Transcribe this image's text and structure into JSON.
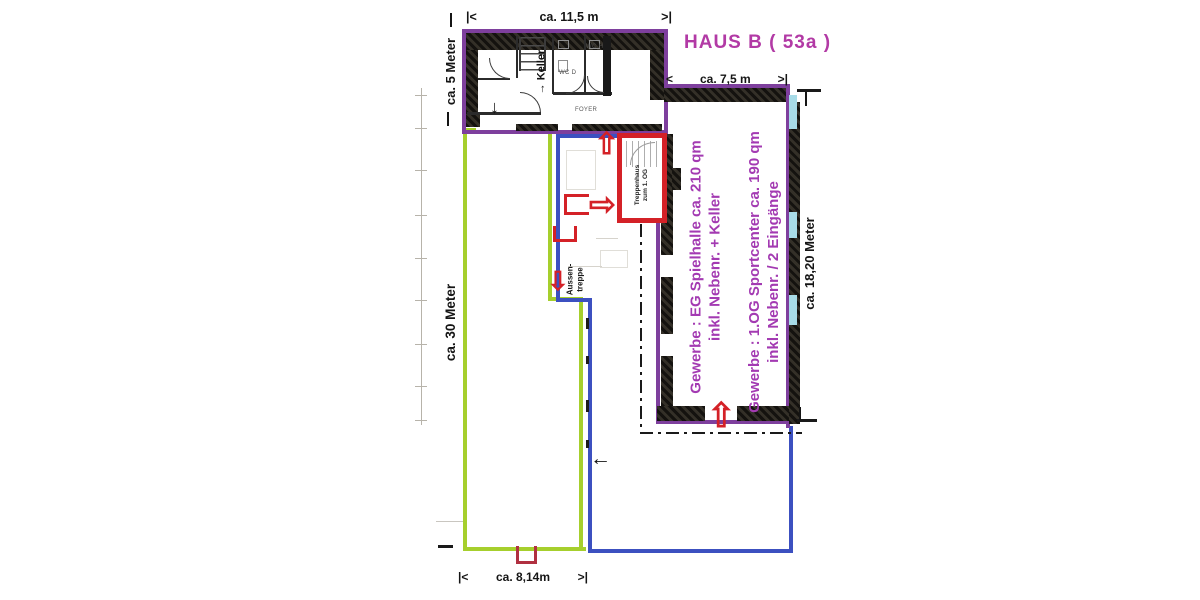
{
  "header": {
    "title": "HAUS B ( 53a )"
  },
  "dimensions": {
    "top": {
      "left_marker": "|<",
      "label": "ca. 11,5 m",
      "right_marker": ">|"
    },
    "wing": {
      "left_marker": "<",
      "label": "ca. 7,5 m",
      "right_marker": ">|"
    },
    "bottom": {
      "left_marker": "|<",
      "label": "ca. 8,14m",
      "right_marker": ">|"
    },
    "left_upper": "ca. 5 Meter",
    "left_lower": "ca. 30 Meter",
    "right_side": "ca. 18,20 Meter"
  },
  "floorplan_labels": {
    "keller_arrow": "→",
    "keller": "Keller",
    "wc_h": "WC H",
    "wc_d": "WC D",
    "foyer": "FOYER",
    "treppenhaus_line1": "Treppenhaus",
    "treppenhaus_line2": "zum 1. OG",
    "aussentreppe_line1": "Aussen-",
    "aussentreppe_line2": "treppe"
  },
  "annotations": {
    "gewerbe_eg": {
      "line1": "Gewerbe : EG Spielhalle ca. 210 qm",
      "line2": "inkl. Nebenr. + Keller"
    },
    "gewerbe_og": {
      "line1": "Gewerbe : 1.OG Sportcenter ca. 190 qm",
      "line2": "inkl. Nebenr. / 2 Eingänge"
    }
  },
  "icons": {
    "entrance_arrow_up": "⇧",
    "entrance_arrow_right": "⇨",
    "entrance_arrow_down": "⇩",
    "foyer_arrow_down": "↓",
    "direction_arrow_left": "←"
  },
  "colors": {
    "outline_purple": "#7e3f9d",
    "text_magenta": "#b23aa5",
    "text_purple": "#a33ab2",
    "outline_green": "#a6cf2d",
    "outline_blue": "#3c50c0",
    "marker_red": "#d42127",
    "wall_black": "#1e1c1a",
    "window_cyan": "#a8dce8"
  }
}
